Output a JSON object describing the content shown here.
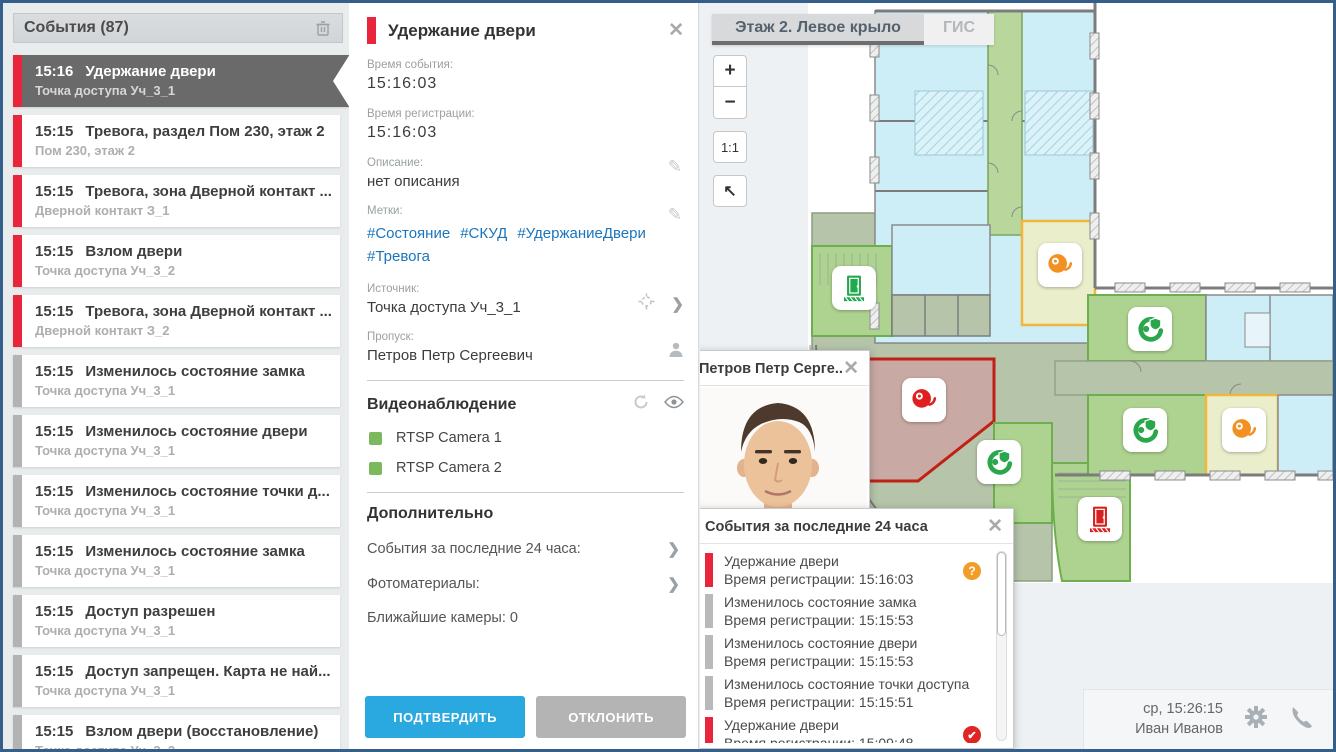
{
  "colors": {
    "frame_blue": "#335f8a",
    "accent_blue": "#29a9e0",
    "alarm_red": "#e8253a",
    "selected_gray": "#6a6a6a",
    "link_blue": "#1b75bc",
    "cam_green": "#7cb85c",
    "warn_orange": "#f29d27"
  },
  "events_panel": {
    "title": "События (87)",
    "items": [
      {
        "time": "15:16",
        "title": "Удержание двери",
        "subtitle": "Точка доступа Уч_3_1",
        "classes": "red selected"
      },
      {
        "time": "15:15",
        "title": "Тревога, раздел Пом 230, этаж 2",
        "subtitle": "Пом 230, этаж 2",
        "classes": "red"
      },
      {
        "time": "15:15",
        "title": "Тревога, зона Дверной контакт ...",
        "subtitle": "Дверной контакт З_1",
        "classes": "red"
      },
      {
        "time": "15:15",
        "title": "Взлом двери",
        "subtitle": "Точка доступа Уч_3_2",
        "classes": "red"
      },
      {
        "time": "15:15",
        "title": "Тревога, зона Дверной контакт ...",
        "subtitle": "Дверной контакт З_2",
        "classes": "red"
      },
      {
        "time": "15:15",
        "title": "Изменилось состояние замка",
        "subtitle": "Точка доступа Уч_3_1",
        "classes": "gray"
      },
      {
        "time": "15:15",
        "title": "Изменилось состояние двери",
        "subtitle": "Точка доступа Уч_3_1",
        "classes": "gray"
      },
      {
        "time": "15:15",
        "title": "Изменилось состояние точки д...",
        "subtitle": "Точка доступа Уч_3_1",
        "classes": "gray"
      },
      {
        "time": "15:15",
        "title": "Изменилось состояние замка",
        "subtitle": "Точка доступа Уч_3_1",
        "classes": "gray"
      },
      {
        "time": "15:15",
        "title": "Доступ разрешен",
        "subtitle": "Точка доступа Уч_3_1",
        "classes": "gray"
      },
      {
        "time": "15:15",
        "title": "Доступ запрещен. Карта не най...",
        "subtitle": "Точка доступа Уч_3_1",
        "classes": "gray"
      },
      {
        "time": "15:15",
        "title": "Взлом двери (восстановление)",
        "subtitle": "Точка доступа Уч_3_2",
        "classes": "gray"
      }
    ]
  },
  "detail": {
    "title": "Удержание двери",
    "event_time_label": "Время события:",
    "event_time": "15:16:03",
    "reg_time_label": "Время регистрации:",
    "reg_time": "15:16:03",
    "description_label": "Описание:",
    "description": "нет описания",
    "tags_label": "Метки:",
    "tags": [
      {
        "text": "#Состояние"
      },
      {
        "text": "#СКУД"
      },
      {
        "text": "#УдержаниеДвери"
      },
      {
        "text": "#Тревога"
      }
    ],
    "source_label": "Источник:",
    "source": "Точка доступа Уч_3_1",
    "pass_label": "Пропуск:",
    "pass": "Петров Петр Сергеевич",
    "video_title": "Видеонаблюдение",
    "cameras": [
      {
        "label": "RTSP Camera 1"
      },
      {
        "label": "RTSP Camera 2"
      }
    ],
    "extra_title": "Дополнительно",
    "extra_rows": [
      {
        "label": "События за последние 24 часа:",
        "chev": "show"
      },
      {
        "label": "Фотоматериалы:",
        "chev": "show"
      },
      {
        "label": "Ближайшие камеры: 0",
        "chev": ""
      }
    ],
    "confirm_label": "ПОДТВЕРДИТЬ",
    "decline_label": "ОТКЛОНИТЬ"
  },
  "map": {
    "tabs": [
      {
        "label": "Этаж 2. Левое крыло"
      },
      {
        "label": "ГИС"
      }
    ],
    "zoom_in": "+",
    "zoom_out": "−",
    "zoom_scale": "1:1",
    "zoom_home": "↖",
    "alarms": [
      {
        "left": 202,
        "top": 375,
        "cls": "red"
      },
      {
        "left": 338,
        "top": 240,
        "cls": "orange"
      },
      {
        "left": 522,
        "top": 405,
        "cls": "orange"
      }
    ],
    "access_points": [
      {
        "left": 428,
        "top": 304,
        "cls": ""
      },
      {
        "left": 423,
        "top": 405,
        "cls": ""
      },
      {
        "left": 277,
        "top": 437,
        "cls": ""
      }
    ],
    "doors": [
      {
        "left": 132,
        "top": 263,
        "cls": "green"
      },
      {
        "left": 378,
        "top": 494,
        "cls": "red"
      }
    ]
  },
  "photo_popup": {
    "title": "Петров Петр Серге..."
  },
  "recent_popup": {
    "title": "События за последние 24 часа",
    "items": [
      {
        "title": "Удержание двери",
        "subtitle": "Время регистрации: 15:16:03",
        "classes": "red",
        "badge": "question"
      },
      {
        "title": "Изменилось состояние замка",
        "subtitle": "Время регистрации: 15:15:53",
        "classes": "gray",
        "badge": ""
      },
      {
        "title": "Изменилось состояние двери",
        "subtitle": "Время регистрации: 15:15:53",
        "classes": "gray",
        "badge": ""
      },
      {
        "title": "Изменилось состояние точки доступа",
        "subtitle": "Время регистрации: 15:15:51",
        "classes": "gray",
        "badge": ""
      },
      {
        "title": "Удержание двери",
        "subtitle": "Время регистрации: 15:09:48",
        "classes": "red",
        "badge": "check"
      }
    ]
  },
  "status": {
    "time": "ср, 15:26:15",
    "user": "Иван Иванов"
  }
}
